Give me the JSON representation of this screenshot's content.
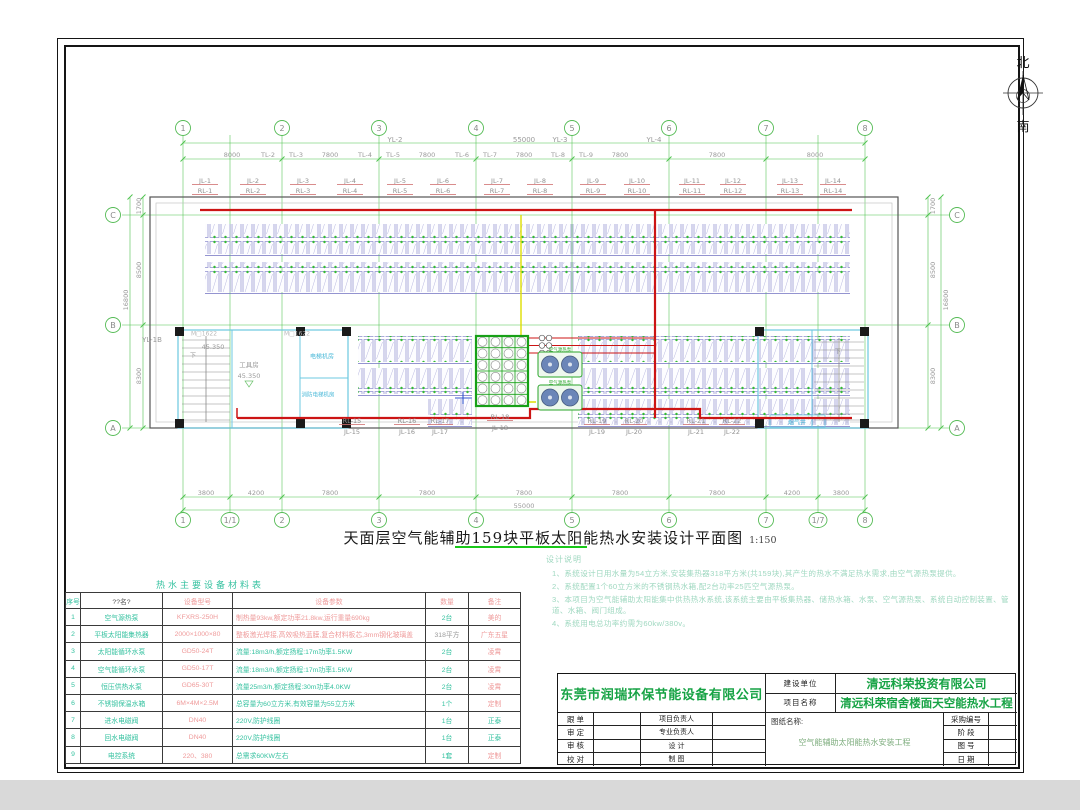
{
  "compass": {
    "north": "北",
    "south": "南"
  },
  "drawing_title": {
    "text": "天面层空气能辅助159块平板太阳能热水安装设计平面图",
    "scale": "1:150"
  },
  "colors": {
    "grid_green": "#4cc24c",
    "dim_text": "#9a9a9a",
    "panel_purple": "#8a8acc",
    "panel_dot_green": "#33bb33",
    "pipe_red": "#cc1414",
    "pipe_yellow": "#dede00",
    "tank_green": "#17a017",
    "core_cyan": "#6cc8e0",
    "table_teal": "#36c2a0",
    "table_salmon": "#ef9a9a",
    "note_green": "#9fd8c0",
    "brand_green": "#17a345",
    "underline_green": "#19c819",
    "collector_purple": "#7070c0",
    "pump_blue": "#6b86b8",
    "label_gray": "#9a9a9a"
  },
  "plan": {
    "grid_top": [
      "1",
      "2",
      "3",
      "4",
      "5",
      "6",
      "7",
      "8"
    ],
    "grid_bottom": [
      "1",
      "1/1",
      "2",
      "3",
      "4",
      "5",
      "6",
      "7",
      "1/7",
      "8"
    ],
    "grid_rows_left": [
      "C",
      "B",
      "A"
    ],
    "grid_rows_right": [
      "C",
      "B",
      "A"
    ],
    "yl_line": [
      "YL-2",
      "55000",
      "YL-3",
      "YL-4"
    ],
    "dims_top": [
      "8000",
      "7800",
      "7800",
      "7800",
      "7800",
      "7800",
      "8000"
    ],
    "tl_labels": [
      "TL-2",
      "TL-3",
      "TL-4",
      "TL-5",
      "TL-6",
      "TL-7",
      "TL-8",
      "TL-9"
    ],
    "dims_bottom": [
      "3800",
      "4200",
      "7800",
      "7800",
      "7800",
      "7800",
      "7800",
      "4200",
      "3800"
    ],
    "total_bottom": "55000",
    "side_dims": [
      "1700",
      "8500",
      "8300"
    ],
    "side_total": "16800",
    "jl_top": [
      "JL-1",
      "JL-2",
      "JL-3",
      "JL-4",
      "JL-5",
      "JL-6",
      "JL-7",
      "JL-8",
      "JL-9",
      "JL-10",
      "JL-11",
      "JL-12",
      "JL-13",
      "JL-14"
    ],
    "rl_top": [
      "RL-1",
      "RL-2",
      "RL-3",
      "RL-4",
      "RL-5",
      "RL-6",
      "RL-7",
      "RL-8",
      "RL-9",
      "RL-10",
      "RL-11",
      "RL-12",
      "RL-13",
      "RL-14"
    ],
    "rl_bottom": [
      "RL-15",
      "RL-16",
      "RL-17",
      "RL-18",
      "RL-19",
      "RL-20",
      "RL-21",
      "RL-22"
    ],
    "jl_bottom": [
      "JL-15",
      "JL-16",
      "JL-17",
      "JL-18",
      "JL-19",
      "JL-20",
      "JL-21",
      "JL-22"
    ],
    "misc": [
      "YL-1B",
      "45.350",
      "工具房",
      "45.350",
      "电梯机房",
      "消防电梯机房",
      "M□1622",
      "M□1622",
      "下",
      "下",
      "烟气井",
      "空气源热泵",
      "空气源热泵"
    ]
  },
  "table": {
    "title": "热水主要设备材料表",
    "headers": [
      "序号",
      "??名?",
      "设备型号",
      "设备参数",
      "数量",
      "备注"
    ],
    "rows": [
      [
        "1",
        "空气源热泵",
        "KFXRS-250H",
        "制热量93kw,额定功率21.8kw,运行重量690kg",
        "2台",
        "美的"
      ],
      [
        "2",
        "平板太阳能集热器",
        "2000×1000×80",
        "整板激光焊接,高效吸热蓝膜,复合材料板芯,3mm钢化玻璃盖",
        "318平方",
        "广东五星"
      ],
      [
        "3",
        "太阳能循环水泵",
        "GD50-24T",
        "流量:18m3/h,额定扬程:17m功率1.5KW",
        "2台",
        "凌霄"
      ],
      [
        "4",
        "空气能循环水泵",
        "GD50-17T",
        "流量:18m3/h,额定扬程:17m功率1.5KW",
        "2台",
        "凌霄"
      ],
      [
        "5",
        "恒压供热水泵",
        "GD65-30T",
        "流量25m3/h,额定扬程:30m功率4.0KW",
        "2台",
        "凌霄"
      ],
      [
        "6",
        "不锈钢保温水箱",
        "6M×4M×2.5M",
        "总容量为60立方米,有效容量为55立方米",
        "1个",
        "定制"
      ],
      [
        "7",
        "进水电磁阀",
        "DN40",
        "220V,防护线圈",
        "1台",
        "正泰"
      ],
      [
        "8",
        "回水电磁阀",
        "DN40",
        "220V,防护线圈",
        "1台",
        "正泰"
      ],
      [
        "9",
        "电控系统",
        "220、380",
        "总需求60KW左右",
        "1套",
        "定制"
      ]
    ]
  },
  "notes": {
    "title": "设计说明",
    "items": [
      "1、系统设计日用水量为54立方米,安装集热器318平方米(共159块),其产生的热水不满足热水需求,由空气源热泵提供。",
      "2、系统配置1个60立方米的不锈钢热水箱,配2台功率25匹空气源热泵。",
      "3、本项目为空气能辅助太阳能集中供热热水系统,该系统主要由平板集热器、储热水箱、水泵、空气源热泵、系统自动控制装置、管道、水箱、阀门组成。",
      "4、系统用电总功率约需为60kw/380v。"
    ]
  },
  "title_block": {
    "company": "东莞市润瑞环保节能设备有限公司",
    "build_unit_label": "建设单位",
    "build_unit": "清远科荣投资有限公司",
    "project_label": "项目名称",
    "project_name": "清远科荣宿舍楼面天空能热水工程",
    "sheet_label": "图纸名称:",
    "sheet_name": "空气能辅助太阳能热水安装工程",
    "left_labels": [
      "跟 单",
      "审 定",
      "审 核",
      "校 对"
    ],
    "mid_labels": [
      "项目负责人",
      "专业负责人",
      "设 计",
      "制 图"
    ],
    "right_labels": [
      "采购编号",
      "阶 段",
      "图 号",
      "日 期"
    ]
  }
}
